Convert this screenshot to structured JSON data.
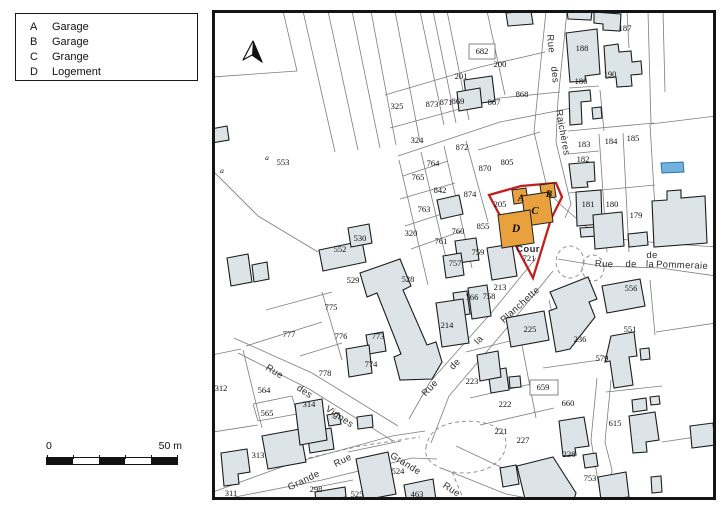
{
  "legend": {
    "items": [
      {
        "key": "A",
        "label": "Garage"
      },
      {
        "key": "B",
        "label": "Garage"
      },
      {
        "key": "C",
        "label": "Grange"
      },
      {
        "key": "D",
        "label": "Logement"
      }
    ]
  },
  "scale_bar": {
    "start": "0",
    "end": "50 m"
  },
  "map": {
    "colors": {
      "building": "#dce4e8",
      "building_stroke": "#1c1c1c",
      "parcel_line": "#7d7d7d",
      "subject_outline": "#c41e1e",
      "subject_fill": "#e8a13c",
      "pond": "#74b2de",
      "frame": "#141414"
    },
    "parcel_labels": [
      {
        "t": "682",
        "x": 482,
        "y": 54
      },
      {
        "t": "200",
        "x": 500,
        "y": 67
      },
      {
        "t": "201",
        "x": 461,
        "y": 79
      },
      {
        "t": "325",
        "x": 397,
        "y": 109
      },
      {
        "t": "873",
        "x": 432,
        "y": 107
      },
      {
        "t": "871",
        "x": 446,
        "y": 105
      },
      {
        "t": "869",
        "x": 458,
        "y": 104
      },
      {
        "t": "867",
        "x": 494,
        "y": 105
      },
      {
        "t": "868",
        "x": 522,
        "y": 97
      },
      {
        "t": "805",
        "x": 507,
        "y": 165
      },
      {
        "t": "187",
        "x": 625,
        "y": 31
      },
      {
        "t": "188",
        "x": 582,
        "y": 51
      },
      {
        "t": "190",
        "x": 610,
        "y": 77
      },
      {
        "t": "186",
        "x": 581,
        "y": 84
      },
      {
        "t": "183",
        "x": 584,
        "y": 147
      },
      {
        "t": "184",
        "x": 611,
        "y": 144
      },
      {
        "t": "185",
        "x": 633,
        "y": 141
      },
      {
        "t": "182",
        "x": 583,
        "y": 162
      },
      {
        "t": "181",
        "x": 588,
        "y": 207
      },
      {
        "t": "180",
        "x": 612,
        "y": 207
      },
      {
        "t": "179",
        "x": 636,
        "y": 218
      },
      {
        "t": "324",
        "x": 417,
        "y": 143
      },
      {
        "t": "872",
        "x": 462,
        "y": 150
      },
      {
        "t": "764",
        "x": 433,
        "y": 166
      },
      {
        "t": "765",
        "x": 418,
        "y": 180
      },
      {
        "t": "842",
        "x": 440,
        "y": 193
      },
      {
        "t": "870",
        "x": 485,
        "y": 171
      },
      {
        "t": "874",
        "x": 470,
        "y": 197
      },
      {
        "t": "763",
        "x": 424,
        "y": 212
      },
      {
        "t": "320",
        "x": 411,
        "y": 236
      },
      {
        "t": "761",
        "x": 441,
        "y": 244
      },
      {
        "t": "760",
        "x": 458,
        "y": 234
      },
      {
        "t": "855",
        "x": 483,
        "y": 229
      },
      {
        "t": "205",
        "x": 500,
        "y": 207
      },
      {
        "t": "553",
        "x": 283,
        "y": 165
      },
      {
        "t": "552",
        "x": 340,
        "y": 252
      },
      {
        "t": "530",
        "x": 360,
        "y": 241
      },
      {
        "t": "529",
        "x": 353,
        "y": 283
      },
      {
        "t": "528",
        "x": 408,
        "y": 282
      },
      {
        "t": "757",
        "x": 455,
        "y": 266
      },
      {
        "t": "759",
        "x": 478,
        "y": 255
      },
      {
        "t": "766",
        "x": 472,
        "y": 300
      },
      {
        "t": "758",
        "x": 489,
        "y": 299
      },
      {
        "t": "213",
        "x": 500,
        "y": 290
      },
      {
        "t": "214",
        "x": 447,
        "y": 328
      },
      {
        "t": "225",
        "x": 530,
        "y": 332
      },
      {
        "t": "721",
        "x": 529,
        "y": 261
      },
      {
        "t": "775",
        "x": 331,
        "y": 310
      },
      {
        "t": "776",
        "x": 341,
        "y": 339
      },
      {
        "t": "773",
        "x": 378,
        "y": 339
      },
      {
        "t": "774",
        "x": 371,
        "y": 367
      },
      {
        "t": "777",
        "x": 289,
        "y": 337
      },
      {
        "t": "778",
        "x": 325,
        "y": 376
      },
      {
        "t": "312",
        "x": 221,
        "y": 391
      },
      {
        "t": "564",
        "x": 264,
        "y": 393
      },
      {
        "t": "565",
        "x": 267,
        "y": 416
      },
      {
        "t": "314",
        "x": 309,
        "y": 407
      },
      {
        "t": "313",
        "x": 258,
        "y": 458
      },
      {
        "t": "311",
        "x": 231,
        "y": 496
      },
      {
        "t": "298",
        "x": 316,
        "y": 492
      },
      {
        "t": "525",
        "x": 357,
        "y": 497
      },
      {
        "t": "524",
        "x": 398,
        "y": 474
      },
      {
        "t": "463",
        "x": 417,
        "y": 497
      },
      {
        "t": "223",
        "x": 472,
        "y": 384
      },
      {
        "t": "222",
        "x": 505,
        "y": 407
      },
      {
        "t": "221",
        "x": 501,
        "y": 434
      },
      {
        "t": "227",
        "x": 523,
        "y": 443
      },
      {
        "t": "659",
        "x": 543,
        "y": 390
      },
      {
        "t": "660",
        "x": 568,
        "y": 406
      },
      {
        "t": "228",
        "x": 569,
        "y": 457
      },
      {
        "t": "615",
        "x": 615,
        "y": 426
      },
      {
        "t": "753",
        "x": 590,
        "y": 481
      },
      {
        "t": "236",
        "x": 580,
        "y": 342
      },
      {
        "t": "579",
        "x": 602,
        "y": 361
      },
      {
        "t": "551",
        "x": 630,
        "y": 332
      },
      {
        "t": "556",
        "x": 631,
        "y": 291
      }
    ],
    "small_labels": [
      {
        "t": "a",
        "x": 267,
        "y": 160
      },
      {
        "t": "a",
        "x": 222,
        "y": 173
      }
    ],
    "street_labels": [
      {
        "t": "Rue",
        "x": 548,
        "y": 44,
        "r": 84
      },
      {
        "t": "des",
        "x": 552,
        "y": 75,
        "r": 84
      },
      {
        "t": "Raichères",
        "x": 560,
        "y": 133,
        "r": 80
      },
      {
        "t": "de",
        "x": 652,
        "y": 258,
        "r": 0,
        "s": 7.5
      },
      {
        "t": "Rue",
        "x": 604,
        "y": 267,
        "r": 2,
        "s": 9
      },
      {
        "t": "de",
        "x": 631,
        "y": 267,
        "r": 2,
        "s": 9
      },
      {
        "t": "la",
        "x": 650,
        "y": 267,
        "r": 2,
        "s": 9
      },
      {
        "t": "Pommeraie",
        "x": 682,
        "y": 268,
        "r": 2,
        "s": 9
      },
      {
        "t": "Rue",
        "x": 432,
        "y": 390,
        "r": -47
      },
      {
        "t": "de",
        "x": 457,
        "y": 366,
        "r": -47
      },
      {
        "t": "la",
        "x": 481,
        "y": 342,
        "r": -47
      },
      {
        "t": "Planchette",
        "x": 522,
        "y": 307,
        "r": -42
      },
      {
        "t": "Rue",
        "x": 273,
        "y": 374,
        "r": 32
      },
      {
        "t": "des",
        "x": 303,
        "y": 394,
        "r": 33
      },
      {
        "t": "Vignes",
        "x": 338,
        "y": 419,
        "r": 34
      },
      {
        "t": "Grande",
        "x": 305,
        "y": 483,
        "r": -26,
        "s": 10
      },
      {
        "t": "Rue",
        "x": 344,
        "y": 463,
        "r": -26,
        "s": 10
      },
      {
        "t": "Grande",
        "x": 404,
        "y": 466,
        "r": 32,
        "s": 10
      },
      {
        "t": "Rue",
        "x": 450,
        "y": 492,
        "r": 33,
        "s": 10
      },
      {
        "t": "Cour",
        "x": 528,
        "y": 252,
        "r": 0,
        "s": 12,
        "w": 600
      }
    ],
    "subject_labels": [
      {
        "t": "A",
        "x": 521,
        "y": 201,
        "s": 9.5
      },
      {
        "t": "B",
        "x": 549,
        "y": 197,
        "s": 9.5
      },
      {
        "t": "C",
        "x": 535,
        "y": 214,
        "s": 11
      },
      {
        "t": "D",
        "x": 516,
        "y": 232,
        "s": 11.5
      }
    ]
  }
}
